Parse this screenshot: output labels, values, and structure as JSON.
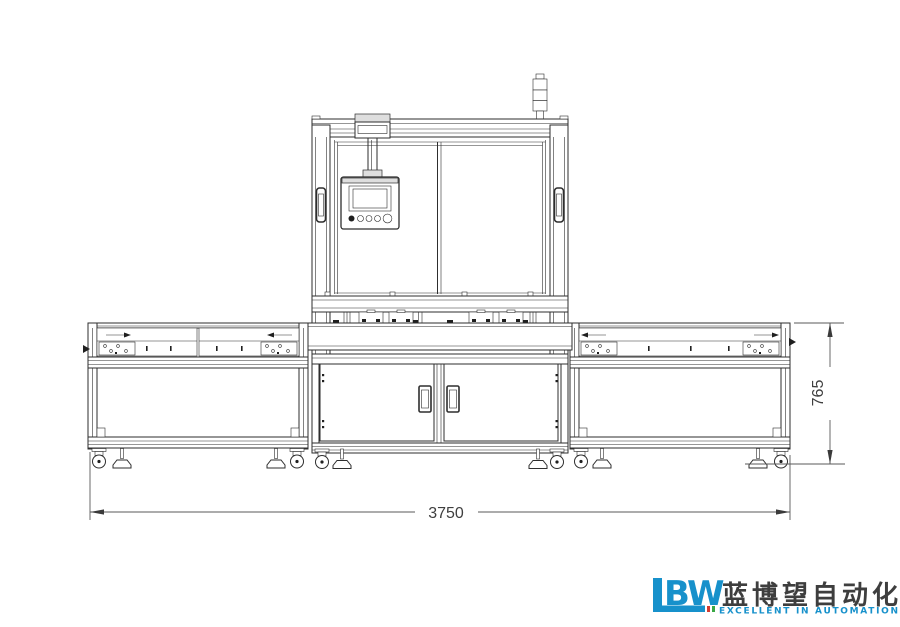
{
  "drawing": {
    "background": "#ffffff",
    "line_color": "#2e2e2e",
    "dimension_color": "#5a5a5a",
    "dimensions": {
      "width_label": "3750",
      "height_label": "765"
    }
  },
  "logo": {
    "acronym": "LBW",
    "acronym_bw_part": "BW",
    "company_name_cjk": "蓝博望自动化",
    "tagline": "EXCELLENT IN AUTOMATION",
    "colors": {
      "blue": "#1791cb",
      "red": "#d43b30",
      "green": "#39a845",
      "cjk_text": "#3e3e3e"
    }
  }
}
